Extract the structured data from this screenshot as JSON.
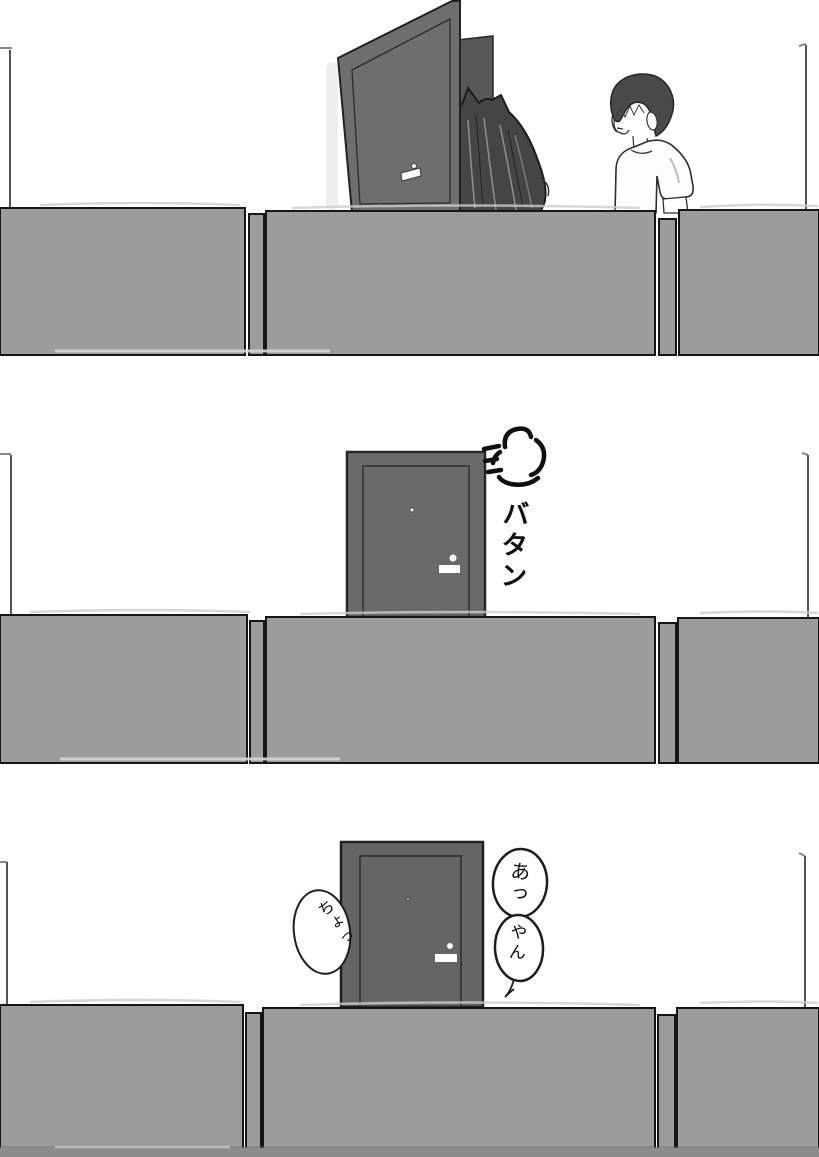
{
  "sfx": {
    "door_slam": "バタン"
  },
  "speech": {
    "left_bubble": "ちょっ",
    "right_top_bubble": "あっ",
    "right_bottom_bubble": "やん"
  },
  "colors": {
    "background": "#ffffff",
    "wall_gray": "#9c9c9c",
    "door_gray": "#6a6a6a",
    "doorway_dark": "#585858",
    "hair_dark": "#454545",
    "ink_black": "#111111",
    "outline_dark": "#1a1a1a"
  }
}
